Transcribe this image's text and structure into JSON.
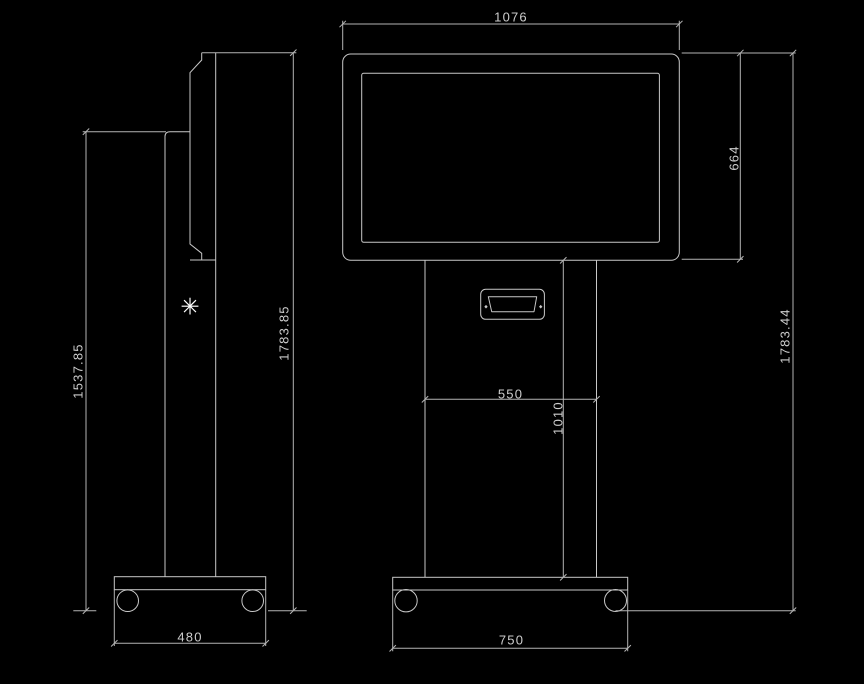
{
  "drawing": {
    "kind": "kiosk-technical-drawing",
    "views": [
      "side-view",
      "front-view"
    ]
  },
  "colors": {
    "background": "#000000",
    "object_line": "#c8c8c8",
    "dimension_line": "#b4b4b4",
    "text": "#cdcdcd",
    "symbol": "#ffffff"
  },
  "symbol": {
    "glyph": "✳"
  },
  "dims": {
    "screen_width": "1076",
    "screen_height": "664",
    "front_total_height": "1783.44",
    "column_width": "550",
    "column_height": "1010",
    "front_base_width": "750",
    "side_column_height": "1537.85",
    "side_total_height": "1783.85",
    "side_base_width": "480"
  }
}
